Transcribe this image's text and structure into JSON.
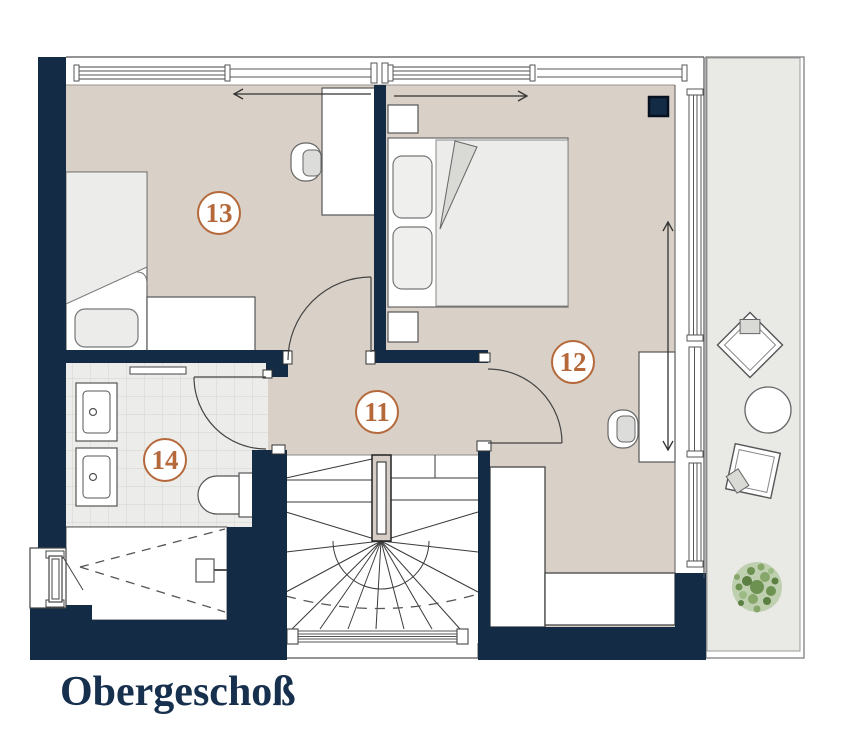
{
  "plan": {
    "title": "Obergeschoß",
    "rooms": [
      {
        "number": "11"
      },
      {
        "number": "12"
      },
      {
        "number": "13"
      },
      {
        "number": "14"
      }
    ],
    "colors": {
      "wall": "#142b45",
      "floor": "#d9d1c8",
      "bath_tile": "#ececea",
      "balcony_floor": "#e9e9e6",
      "room_label_accent": "#b5693b",
      "title_text": "#17304e",
      "plant_green": "#6d9150"
    }
  }
}
